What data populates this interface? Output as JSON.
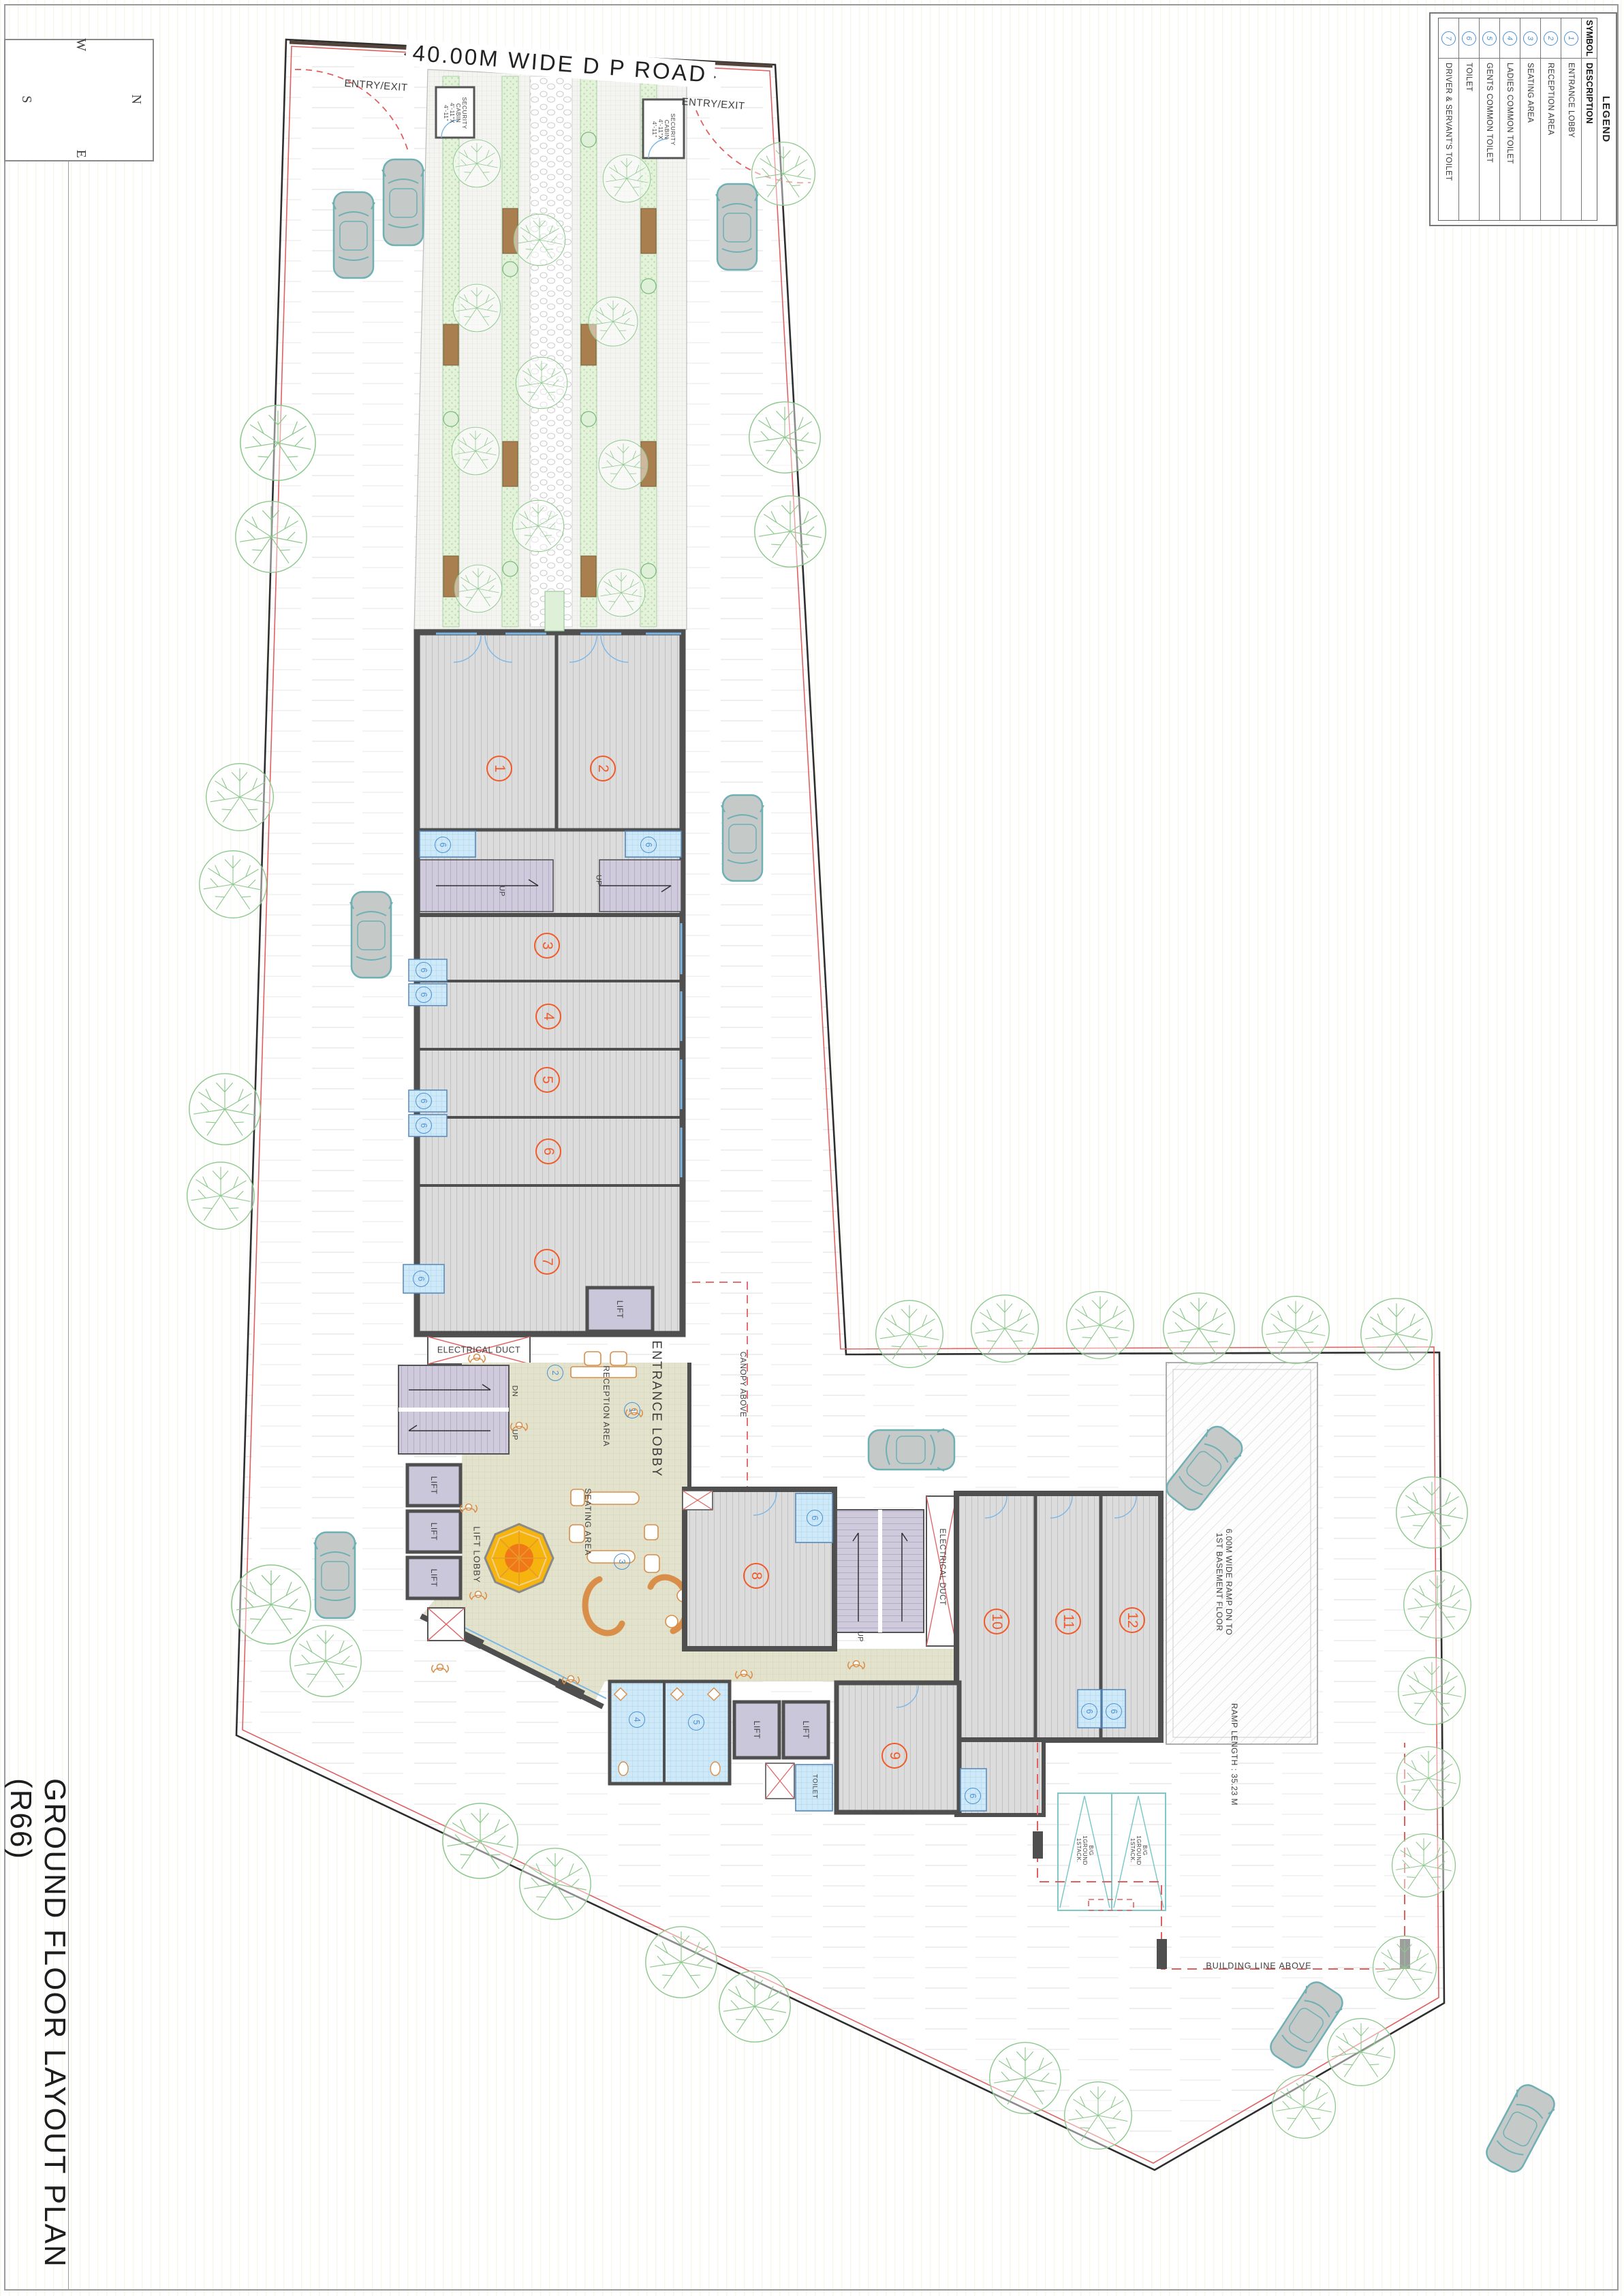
{
  "sheet": {
    "title": "GROUND FLOOR LAYOUT PLAN (R66)"
  },
  "compass": {
    "north": "N",
    "south": "S",
    "east": "E",
    "west": "W"
  },
  "road": {
    "label": "40.00M WIDE D P ROAD",
    "entry_exit_left": "ENTRY/EXIT",
    "entry_exit_right": "ENTRY/EXIT"
  },
  "security_cabins": {
    "left": "SECURITY\nCABIN\n4'-11\"X\n4'-11\"",
    "right": "SECURITY\nCABIN\n4'-11\"X\n4'-11\""
  },
  "legend": {
    "title": "LEGEND",
    "columns": {
      "symbol": "SYMBOL",
      "description": "DESCRIPTION"
    },
    "rows": [
      {
        "symbol": "1",
        "description": "ENTRANCE LOBBY"
      },
      {
        "symbol": "2",
        "description": "RECEPTION AREA"
      },
      {
        "symbol": "3",
        "description": "SEATING AREA"
      },
      {
        "symbol": "4",
        "description": "LADIES COMMON TOILET"
      },
      {
        "symbol": "5",
        "description": "GENTS COMMON TOILET"
      },
      {
        "symbol": "6",
        "description": "TOILET"
      },
      {
        "symbol": "7",
        "description": "DRIVER & SERVANT'S TOILET"
      }
    ]
  },
  "plan": {
    "unit_numbers": [
      "1",
      "2",
      "3",
      "4",
      "5",
      "6",
      "7",
      "8",
      "9",
      "10",
      "11",
      "12"
    ],
    "room_labels": {
      "entrance_lobby": "ENTRANCE LOBBY",
      "reception_area": "RECEPTION AREA",
      "seating_area": "SEATING AREA",
      "lift": "LIFT",
      "lift_lobby": "LIFT LOBBY",
      "toilet": "TOILET",
      "electrical_duct": "ELECTRICAL DUCT",
      "up": "UP",
      "dn": "DN"
    },
    "annotations": {
      "canopy_above": "CANOPY ABOVE",
      "building_line_above": "BUILDING LINE ABOVE",
      "ramp": "6.00M WIDE RAMP DN TO\n1ST BASEMENT FLOOR",
      "ramp_length": "RAMP LENGTH : 35.23 M",
      "stack_parking": "B/G\n1GROUND\n1STACK."
    },
    "ref_circles": {
      "entrance_lobby": "1",
      "reception_area": "2",
      "seating_area": "3",
      "ladies_toilet": "4",
      "gents_toilet": "5",
      "toilet": "6"
    }
  },
  "colors": {
    "unit_number_orange": "#f15a29",
    "ref_circle_blue": "#4a90d4",
    "wall_grey": "#4f4f4f",
    "boundary_red": "#e06060",
    "toilet_fill": "#cfe9f8",
    "lift_fill": "#cbc7da",
    "stair_fill": "#cfcbdd",
    "lobby_fill": "#e3e2cd",
    "tree_green": "#8cc98c",
    "car_teal": "#6fb0b4",
    "bench_brown": "#a97f4f",
    "accent_orange": "#f6b40e"
  }
}
